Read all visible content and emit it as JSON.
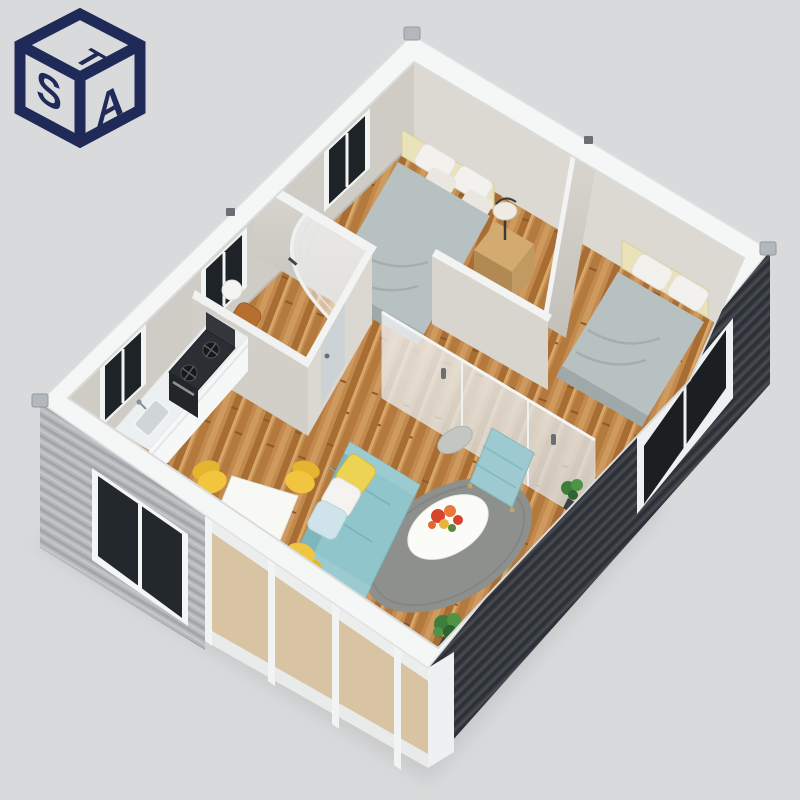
{
  "scene": {
    "description": "3D isometric cutaway rendering of a two-bedroom prefab flat-pack container house, viewed from above",
    "background_color": "#d9dadb"
  },
  "logo": {
    "top_letter": "T",
    "left_letter": "S",
    "right_letter": "A",
    "color": "#202a58",
    "style": "isometric cube monogram"
  },
  "exterior": {
    "frame_color": "#f5f6f6",
    "corner_casting_color": "#aeb3b7",
    "sw_wall": {
      "type": "corrugated-panel",
      "color": "#b7babd",
      "window": {
        "glass": "#23282c",
        "frame": "#f4f5f5",
        "panes": 2
      }
    },
    "se_wall": {
      "type": "corrugated-panel",
      "color": "#3a3e44",
      "window": {
        "glass": "#1b1f22",
        "frame": "#eef0f1",
        "panes": 2
      }
    },
    "glass_curtain_wall": {
      "mullion_color": "#f2f3f3",
      "glass_tint": "#eef2f3",
      "panels": 3
    }
  },
  "interior": {
    "wall_color": "#d2cfc9",
    "floor": {
      "material": "wood-plank",
      "color": "#c28a4f"
    },
    "rooms": [
      {
        "name": "bedroom-1",
        "items": [
          "double-bed",
          "white-pillows",
          "cream-headboard",
          "wood-nightstand",
          "table-lamp",
          "window"
        ]
      },
      {
        "name": "bedroom-2",
        "items": [
          "double-bed",
          "white-pillows",
          "cream-headboard",
          "window"
        ]
      },
      {
        "name": "bathroom",
        "items": [
          "curved-glass-shower",
          "toilet",
          "frosted-door",
          "window"
        ]
      },
      {
        "name": "kitchen",
        "items": [
          "white-counter",
          "sink-with-faucet",
          "dark-gas-range",
          "oven",
          "window"
        ]
      },
      {
        "name": "living-dining",
        "items": [
          "teal-sofa",
          "yellow-pillow",
          "white-pillow",
          "blue-pillow",
          "round-gray-rug",
          "white-coffee-table",
          "flower-bouquet",
          "round-side-table",
          "teal-lounge-chair",
          "white-dining-table",
          "three-yellow-chairs",
          "potted-plants",
          "frosted-glass-sliding-partition"
        ]
      }
    ],
    "colors": {
      "bed_duvet": "#b8c1c2",
      "pillow": "#f3f1ed",
      "headboard": "#eae3b9",
      "nightstand": "#caa268",
      "sofa": "#8fc5cb",
      "pillow_yellow": "#ecd354",
      "pillow_blue": "#cfe4ea",
      "rug": "#8e908d",
      "coffee_table": "#fbfbf8",
      "dining_table": "#f8f8f5",
      "dining_chair": "#f1c63e",
      "range": "#2b2e33",
      "counter": "#edf0f0",
      "plant": "#3e7e3c",
      "flowers": "#d8432f",
      "shower_glass": "#eef0f1",
      "frosted_door": "#ccd3d5"
    }
  }
}
